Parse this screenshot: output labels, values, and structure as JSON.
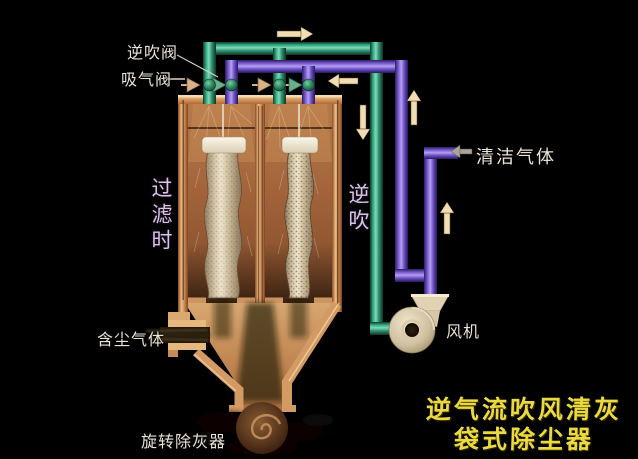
{
  "diagram": {
    "title": {
      "line1": "逆气流吹风清灰",
      "line2": "袋式除尘器"
    },
    "labels": {
      "reverse_blow_valve": "逆吹阀",
      "suction_valve": "吸气阀",
      "clean_gas": "清洁气体",
      "dusty_gas": "含尘气体",
      "fan": "风机",
      "rotary_ash_remover": "旋转除灰器",
      "left_chamber_state": "过滤时",
      "right_chamber_state": "逆吹"
    },
    "flow_arrows": [
      {
        "name": "flow-arrow-top-right",
        "direction": "right",
        "color": "cream"
      },
      {
        "name": "flow-arrow-into-valves",
        "direction": "left",
        "color": "cream"
      },
      {
        "name": "flow-arrow-suction-down",
        "direction": "down",
        "color": "cream"
      },
      {
        "name": "flow-arrow-purple-up",
        "direction": "up",
        "color": "cream"
      },
      {
        "name": "flow-arrow-fan-discharge-up",
        "direction": "up",
        "color": "cream"
      },
      {
        "name": "flow-arrow-clean-gas-out",
        "direction": "left",
        "color": "grey"
      }
    ],
    "colors": {
      "background": "#000000",
      "pipe_green": "#2fa07e",
      "pipe_purple": "#7a5ad0",
      "vessel_tan": "#d49a64",
      "bag_beige": "#cfc0a2",
      "arrow_cream": "#f2dcb2",
      "title_yellow": "#ead93f",
      "label_white": "#e9e2d6",
      "state_label_lavender": "#d9c4e8"
    }
  }
}
